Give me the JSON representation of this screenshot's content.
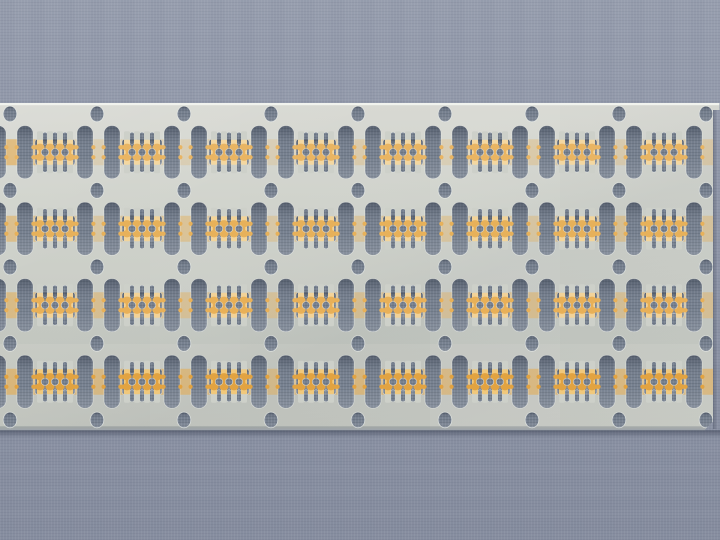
{
  "image": {
    "type": "photograph",
    "subject": "stamped metal lead-frame strip with gold-plated contact lead patterns, lying horizontally on a woven blue-gray fabric surface",
    "width": 720,
    "height": 540
  },
  "colors": {
    "fabric_base": "#8f96a8",
    "cutout_fabric": "#76808f",
    "metal_top": "#d8d9d3",
    "metal_mid": "#cfd2cb",
    "metal_low": "#c3c6bf",
    "metal_finger": "#cdd0c9",
    "edge_highlight": "#f1f3ee",
    "edge_cut": "#9fa5ab",
    "shadow": "rgba(25,32,50,0.40)",
    "cutout_rim": "rgba(246,248,244,0.55)",
    "band_amber": "230,170,75"
  },
  "strip": {
    "top": 103,
    "bottom": 429,
    "right_edge": 713,
    "top_right_tab": {
      "x": 713,
      "y": 103,
      "w": 6.5,
      "h": 7
    },
    "bottom_right_chamfer": 7.5
  },
  "grid": {
    "hole_columns_x": [
      10,
      97,
      184,
      271,
      358,
      445,
      532,
      619,
      706
    ],
    "hole_rows_y": [
      114,
      190.5,
      267,
      343.5,
      420
    ],
    "row_centers_y": [
      152.25,
      228.75,
      305.25,
      381.75
    ],
    "pattern_centers_x": [
      55,
      142,
      229,
      316,
      403,
      490,
      577,
      664
    ],
    "counts": {
      "pattern_rows": 4,
      "pattern_columns": 8,
      "sprocket_holes": 45,
      "tall_slots_per_row": 17
    }
  },
  "sprocket_hole": {
    "rx": 6.8,
    "ry": 7.8
  },
  "tall_slot": {
    "width": 16,
    "height": 53,
    "corner_radius": 7.5,
    "offsets_from_hole_x": [
      7,
      67
    ],
    "partial_left_x": -10,
    "half_height_from_row_center": 26.5
  },
  "lead_pattern": {
    "window_half_width": 20,
    "window_half_height": 13,
    "window_radius": 3,
    "finger_offsets_x": [
      -15,
      -5,
      5,
      15
    ],
    "finger_width": 6,
    "finger_half_height": 21,
    "gap_offsets_x": [
      -10,
      0,
      10
    ],
    "small_slot": {
      "width": 5,
      "height": 12,
      "y_near": 8,
      "y_far": 20,
      "radius": 2.4
    },
    "bell": {
      "rx": 4.6,
      "ry": 3.6,
      "y_offset": 5
    },
    "neck": {
      "width": 2.6,
      "half_height": 6
    },
    "center_circle_r": 3.7,
    "tab": {
      "r": 2.1,
      "x_offset": 19.5,
      "y_offset": 5
    }
  },
  "plating_bands": {
    "half_height": 13,
    "row_alpha_profiles": [
      [
        [
          0,
          0.62
        ],
        [
          0.05,
          0.58
        ],
        [
          0.09,
          0.2
        ],
        [
          0.2,
          0.24
        ],
        [
          0.35,
          0.18
        ],
        [
          0.5,
          0.27
        ],
        [
          0.62,
          0.2
        ],
        [
          0.75,
          0.3
        ],
        [
          0.88,
          0.23
        ],
        [
          1,
          0.3
        ]
      ],
      [
        [
          0,
          0.52
        ],
        [
          0.07,
          0.46
        ],
        [
          0.12,
          0.3
        ],
        [
          0.25,
          0.42
        ],
        [
          0.4,
          0.28
        ],
        [
          0.55,
          0.38
        ],
        [
          0.7,
          0.3
        ],
        [
          0.85,
          0.4
        ],
        [
          1,
          0.34
        ]
      ],
      [
        [
          0,
          0.55
        ],
        [
          0.1,
          0.4
        ],
        [
          0.2,
          0.46
        ],
        [
          0.33,
          0.3
        ],
        [
          0.45,
          0.42
        ],
        [
          0.6,
          0.34
        ],
        [
          0.75,
          0.44
        ],
        [
          0.9,
          0.36
        ],
        [
          1,
          0.4
        ]
      ],
      [
        [
          0,
          0.62
        ],
        [
          0.12,
          0.5
        ],
        [
          0.22,
          0.58
        ],
        [
          0.38,
          0.45
        ],
        [
          0.5,
          0.56
        ],
        [
          0.65,
          0.48
        ],
        [
          0.8,
          0.58
        ],
        [
          0.92,
          0.5
        ],
        [
          1,
          0.55
        ]
      ]
    ]
  },
  "gold_by_row": [
    {
      "main": "#e9b563",
      "pale": "#f3d7a1"
    },
    {
      "main": "#e7b15a",
      "pale": "#f2d49a"
    },
    {
      "main": "#e8b058",
      "pale": "#f2d298"
    },
    {
      "main": "#e2a341",
      "pale": "#f0c87c"
    }
  ]
}
